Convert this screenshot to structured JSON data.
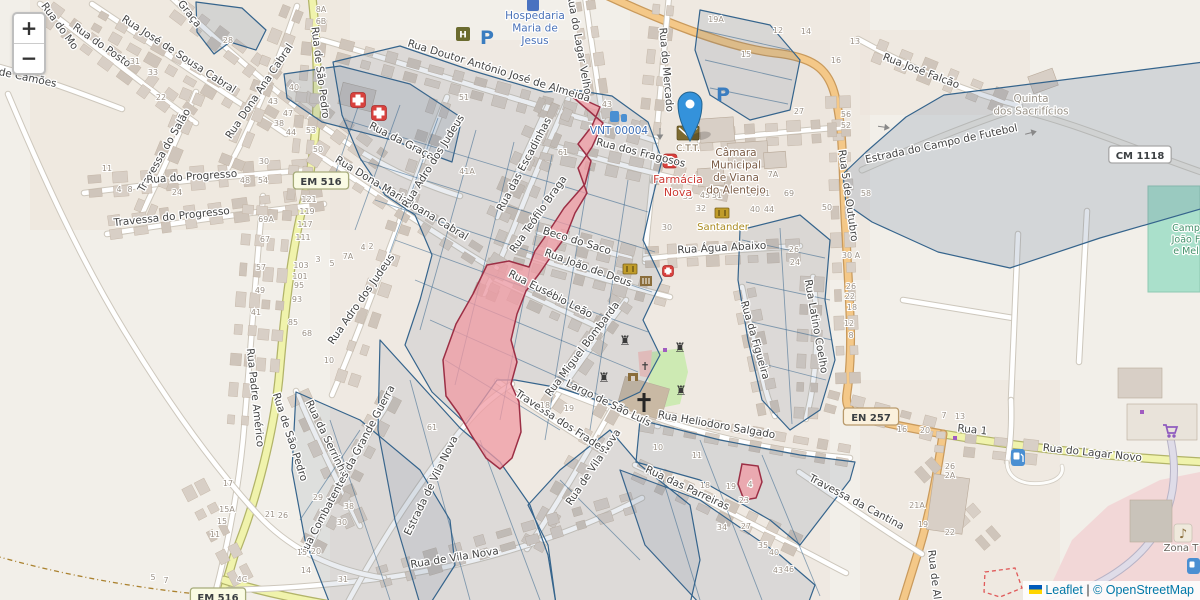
{
  "zoom": {
    "in": "+",
    "out": "−"
  },
  "attribution": {
    "leaflet": "Leaflet",
    "sep": "|",
    "osm": "© OpenStreetMap"
  },
  "colors": {
    "marker_blue": "#3492db",
    "parcel_stroke": "#35648c",
    "parcel_fill": "#5a7396",
    "pink_fill": "#f09aa3",
    "pink_stroke": "#9c2f45",
    "road_yellow": "#f0f3ac",
    "road_orange": "#f4c888",
    "poi_blue": "#4a72b8",
    "poi_red": "#cc3a33",
    "poi_brown": "#7a5b45",
    "field_green": "#aae0cb"
  },
  "badges": [
    {
      "label": "EM 516",
      "x": 321,
      "y": 181,
      "s": "em"
    },
    {
      "label": "EM 516",
      "x": 218,
      "y": 597,
      "s": "em"
    },
    {
      "label": "EN 257",
      "x": 871,
      "y": 417,
      "s": "en"
    },
    {
      "label": "CM 1118",
      "x": 1140,
      "y": 155,
      "s": "cm"
    }
  ],
  "streets": [
    [
      "Rua do Mo",
      57,
      28,
      54
    ],
    [
      "Rua do Posto",
      100,
      48,
      35
    ],
    [
      "Rua José de Sousa Cabral",
      177,
      57,
      33
    ],
    [
      "a Graça",
      184,
      12,
      52
    ],
    [
      "Rua da Graça",
      400,
      144,
      27
    ],
    [
      "de Camões",
      27,
      81,
      12
    ],
    [
      "Rua Dona Ana Cabral",
      262,
      93,
      -56
    ],
    [
      "Travessa do Salão",
      167,
      152,
      -60
    ],
    [
      "Rua do Progresso",
      192,
      180,
      -4
    ],
    [
      "Travessa do Progresso",
      172,
      220,
      -6
    ],
    [
      "Rua Dona Maria Joana Cabral",
      400,
      201,
      31
    ],
    [
      "Rua de São Pedro",
      317,
      73,
      83
    ],
    [
      "Rua de São Pedro",
      287,
      438,
      72
    ],
    [
      "Rua Padre Américo",
      252,
      398,
      84
    ],
    [
      "Rua da Serrinha",
      324,
      440,
      64
    ],
    [
      "Rua Combatentes da Grande Guerra",
      350,
      472,
      -62
    ],
    [
      "Estrada de Vila Nova",
      434,
      487,
      -64
    ],
    [
      "Rua de Vila Nova",
      596,
      469,
      -56
    ],
    [
      "Rua de Vila Nova",
      455,
      561,
      -9
    ],
    [
      "Travessa dos Frades",
      559,
      424,
      33
    ],
    [
      "Rua das Escadinhas",
      527,
      166,
      -62
    ],
    [
      "Rua Teófilo Braga",
      541,
      216,
      -55
    ],
    [
      "Beco do Saco",
      576,
      244,
      17
    ],
    [
      "Rua João de Deus",
      587,
      271,
      20
    ],
    [
      "Rua Eusébio Leão",
      549,
      297,
      27
    ],
    [
      "Rua Miguel Bombarda",
      585,
      351,
      -53
    ],
    [
      "Largo de São Luís",
      607,
      406,
      26
    ],
    [
      "Rua dos Fragosos",
      640,
      156,
      14
    ],
    [
      "Rua Doutor António José de Almeida",
      498,
      74,
      17
    ],
    [
      "Rua do Lagar Velho",
      576,
      45,
      80
    ],
    [
      "Rua do Mercado",
      663,
      70,
      85
    ],
    [
      "Rua Adro dos Judeus",
      436,
      163,
      -58
    ],
    [
      "Rua Adro dos Judeus",
      364,
      301,
      -55
    ],
    [
      "Rua Água Abaixo",
      722,
      251,
      -3
    ],
    [
      "Rua da Figueira",
      752,
      341,
      74
    ],
    [
      "Rua Latino Coelho",
      813,
      327,
      80
    ],
    [
      "Rua Heliodoro Salgado",
      716,
      428,
      10
    ],
    [
      "Rua das Parreiras",
      686,
      491,
      25
    ],
    [
      "Travessa da Cantina",
      855,
      505,
      28
    ],
    [
      "Rua 5 de Outubro",
      845,
      196,
      82
    ],
    [
      "Rua José Falcão",
      920,
      74,
      21
    ],
    [
      "Estrada do Campo de Futebol",
      942,
      147,
      -12
    ],
    [
      "Rua do Lagar Novo",
      1092,
      456,
      6
    ],
    [
      "Rua 1",
      972,
      433,
      6
    ],
    [
      "Rua de Al",
      931,
      575,
      83
    ]
  ],
  "pois": [
    {
      "lines": [
        "Hospedaria",
        "Maria de",
        "Jesus"
      ],
      "x": 535,
      "y": 19,
      "c": "#4a72b8",
      "fs": 10.5
    },
    {
      "lines": [
        "VNT 00004"
      ],
      "x": 619,
      "y": 134,
      "c": "#3a6cb5",
      "fs": 10.5
    },
    {
      "lines": [
        "C.T.T."
      ],
      "x": 688,
      "y": 151,
      "c": "#7a6548",
      "fs": 9
    },
    {
      "lines": [
        "Câmara",
        "Municipal",
        "de Viana",
        "do Alentejo"
      ],
      "x": 736,
      "y": 156,
      "c": "#7a5b45",
      "fs": 10.5
    },
    {
      "lines": [
        "Farmácia",
        "Nova"
      ],
      "x": 678,
      "y": 183,
      "c": "#cc3a33",
      "fs": 11
    },
    {
      "lines": [
        "Santander"
      ],
      "x": 723,
      "y": 230,
      "c": "#aa8a1f",
      "fs": 10
    },
    {
      "lines": [
        "Quinta",
        "dos Sacrifícios"
      ],
      "x": 1031,
      "y": 102,
      "c": "#999288",
      "fs": 10.5
    },
    {
      "lines": [
        "Camp",
        "João F",
        "e Mel"
      ],
      "x": 1186,
      "y": 231,
      "c": "#43916a",
      "fs": 9.5
    },
    {
      "lines": [
        "Zona T"
      ],
      "x": 1181,
      "y": 551,
      "c": "#6a655e",
      "fs": 10
    }
  ],
  "numbers": [
    [
      "28",
      228,
      43
    ],
    [
      "8A",
      321,
      12
    ],
    [
      "6B",
      321,
      24
    ],
    [
      "40",
      294,
      90
    ],
    [
      "43",
      273,
      104
    ],
    [
      "47",
      288,
      116
    ],
    [
      "38",
      279,
      126
    ],
    [
      "44",
      291,
      135
    ],
    [
      "53",
      311,
      133
    ],
    [
      "50",
      318,
      152
    ],
    [
      "30",
      264,
      164
    ],
    [
      "48",
      245,
      183
    ],
    [
      "54",
      263,
      183
    ],
    [
      "24",
      177,
      195
    ],
    [
      "31",
      135,
      64
    ],
    [
      "33",
      153,
      75
    ],
    [
      "22",
      161,
      100
    ],
    [
      "11",
      107,
      171
    ],
    [
      "4",
      119,
      192
    ],
    [
      "8",
      130,
      192
    ],
    [
      "69A",
      266,
      222
    ],
    [
      "67",
      265,
      242
    ],
    [
      "57",
      261,
      270
    ],
    [
      "49",
      260,
      293
    ],
    [
      "41",
      256,
      315
    ],
    [
      "121",
      309,
      202
    ],
    [
      "119",
      307,
      214
    ],
    [
      "117",
      305,
      227
    ],
    [
      "111",
      303,
      240
    ],
    [
      "103",
      301,
      268
    ],
    [
      "101",
      300,
      279
    ],
    [
      "95",
      299,
      288
    ],
    [
      "93",
      297,
      302
    ],
    [
      "85",
      293,
      325
    ],
    [
      "68",
      307,
      336
    ],
    [
      "3",
      318,
      262
    ],
    [
      "5",
      332,
      266
    ],
    [
      "7A",
      348,
      259
    ],
    [
      "2",
      371,
      249
    ],
    [
      "4",
      363,
      250
    ],
    [
      "10",
      329,
      363
    ],
    [
      "41A",
      467,
      174
    ],
    [
      "51",
      464,
      100
    ],
    [
      "61",
      563,
      155
    ],
    [
      "43",
      607,
      107
    ],
    [
      "19A",
      716,
      22
    ],
    [
      "12",
      778,
      33
    ],
    [
      "15",
      746,
      57
    ],
    [
      "27",
      799,
      114
    ],
    [
      "7A",
      773,
      177
    ],
    [
      "35",
      688,
      199
    ],
    [
      "45",
      705,
      198
    ],
    [
      "51",
      717,
      198
    ],
    [
      "57",
      752,
      196
    ],
    [
      "61",
      765,
      196
    ],
    [
      "69",
      789,
      196
    ],
    [
      "32",
      701,
      211
    ],
    [
      "40",
      755,
      212
    ],
    [
      "44",
      769,
      212
    ],
    [
      "30",
      667,
      230
    ],
    [
      "26",
      794,
      252
    ],
    [
      "24",
      795,
      265
    ],
    [
      "30 A",
      851,
      258
    ],
    [
      "26",
      851,
      289
    ],
    [
      "22",
      850,
      299
    ],
    [
      "18",
      852,
      310
    ],
    [
      "12",
      849,
      326
    ],
    [
      "8",
      851,
      338
    ],
    [
      "50",
      827,
      210
    ],
    [
      "56",
      846,
      117
    ],
    [
      "52",
      846,
      128
    ],
    [
      "14",
      806,
      34
    ],
    [
      "13",
      855,
      44
    ],
    [
      "16",
      836,
      63
    ],
    [
      "58",
      866,
      196
    ],
    [
      "17",
      228,
      486
    ],
    [
      "15A",
      227,
      512
    ],
    [
      "15",
      222,
      524
    ],
    [
      "11",
      215,
      537
    ],
    [
      "5",
      153,
      580
    ],
    [
      "7",
      166,
      583
    ],
    [
      "4C",
      242,
      582
    ],
    [
      "21",
      270,
      517
    ],
    [
      "26",
      283,
      518
    ],
    [
      "29",
      318,
      500
    ],
    [
      "38",
      349,
      509
    ],
    [
      "30",
      342,
      525
    ],
    [
      "20",
      316,
      554
    ],
    [
      "15",
      302,
      555
    ],
    [
      "14",
      306,
      573
    ],
    [
      "31",
      343,
      582
    ],
    [
      "61",
      432,
      430
    ],
    [
      "18",
      545,
      408
    ],
    [
      "19",
      569,
      411
    ],
    [
      "10",
      658,
      450
    ],
    [
      "11",
      697,
      458
    ],
    [
      "18",
      705,
      488
    ],
    [
      "19",
      731,
      489
    ],
    [
      "23",
      744,
      503
    ],
    [
      "4",
      750,
      487
    ],
    [
      "34",
      722,
      530
    ],
    [
      "27",
      746,
      529
    ],
    [
      "35",
      763,
      548
    ],
    [
      "40",
      774,
      555
    ],
    [
      "46",
      789,
      572
    ],
    [
      "43",
      778,
      573
    ],
    [
      "16",
      902,
      432
    ],
    [
      "20",
      925,
      433
    ],
    [
      "7",
      944,
      418
    ],
    [
      "13",
      960,
      419
    ],
    [
      "26",
      950,
      469
    ],
    [
      "2A",
      950,
      478
    ],
    [
      "21A",
      917,
      508
    ],
    [
      "19",
      923,
      527
    ],
    [
      "22",
      950,
      535
    ]
  ],
  "icons": [
    {
      "name": "parking-icon",
      "t": "parking",
      "x": 487,
      "y": 44
    },
    {
      "name": "parking-icon",
      "t": "parking",
      "x": 723,
      "y": 101
    },
    {
      "name": "hospital-icon",
      "t": "medcross",
      "x": 358,
      "y": 100,
      "s": 15
    },
    {
      "name": "hospital-icon",
      "t": "medcross",
      "x": 379,
      "y": 113,
      "s": 15
    },
    {
      "name": "pharmacy-icon",
      "t": "medcross",
      "x": 670,
      "y": 161,
      "s": 14
    },
    {
      "name": "firstaid-icon",
      "t": "medcross",
      "x": 668,
      "y": 271,
      "s": 11
    },
    {
      "name": "post-office-icon",
      "t": "post",
      "x": 688,
      "y": 133
    },
    {
      "name": "bank-icon",
      "t": "bank",
      "x": 722,
      "y": 213
    },
    {
      "name": "atm-icon",
      "t": "bank",
      "x": 630,
      "y": 269
    },
    {
      "name": "museum-icon",
      "t": "museum",
      "x": 646,
      "y": 281
    },
    {
      "name": "castle-tower-icon",
      "t": "rook",
      "x": 625,
      "y": 341
    },
    {
      "name": "castle-tower-icon",
      "t": "rook",
      "x": 680,
      "y": 348
    },
    {
      "name": "castle-tower-icon",
      "t": "rook",
      "x": 604,
      "y": 378
    },
    {
      "name": "castle-tower-icon",
      "t": "rook",
      "x": 681,
      "y": 391
    },
    {
      "name": "church-cross-icon",
      "t": "crossbig",
      "x": 644,
      "y": 404
    },
    {
      "name": "wayside-cross-icon",
      "t": "crosssmall",
      "x": 645,
      "y": 366
    },
    {
      "name": "gate-icon",
      "t": "gate",
      "x": 633,
      "y": 377
    },
    {
      "name": "fuel-icon",
      "t": "fuel",
      "x": 1018,
      "y": 458
    },
    {
      "name": "supermarket-icon",
      "t": "cart",
      "x": 1170,
      "y": 431
    },
    {
      "name": "music-venue-icon",
      "t": "music",
      "x": 1183,
      "y": 533
    },
    {
      "name": "drinking-water-icon",
      "t": "water",
      "x": 618,
      "y": 117
    },
    {
      "name": "hotel-icon",
      "t": "hotel",
      "x": 533,
      "y": 4
    },
    {
      "name": "guesthouse-icon",
      "t": "hotelH",
      "x": 463,
      "y": 34
    },
    {
      "name": "poi-dot-icon",
      "t": "dot",
      "x": 665,
      "y": 350
    },
    {
      "name": "poi-dot-icon",
      "t": "dot",
      "x": 955,
      "y": 438
    },
    {
      "name": "poi-dot-icon",
      "t": "dot",
      "x": 1142,
      "y": 412
    },
    {
      "name": "poi-partial-icon",
      "t": "bluehalf",
      "x": 1193,
      "y": 566
    },
    {
      "name": "oneway-arrow-icon",
      "t": "arrow",
      "x": 660,
      "y": 133,
      "r": 90
    },
    {
      "name": "oneway-arrow-icon",
      "t": "arrow",
      "x": 883,
      "y": 127,
      "r": 8
    },
    {
      "name": "oneway-arrow-icon",
      "t": "arrow",
      "x": 1030,
      "y": 133,
      "r": -14
    }
  ]
}
